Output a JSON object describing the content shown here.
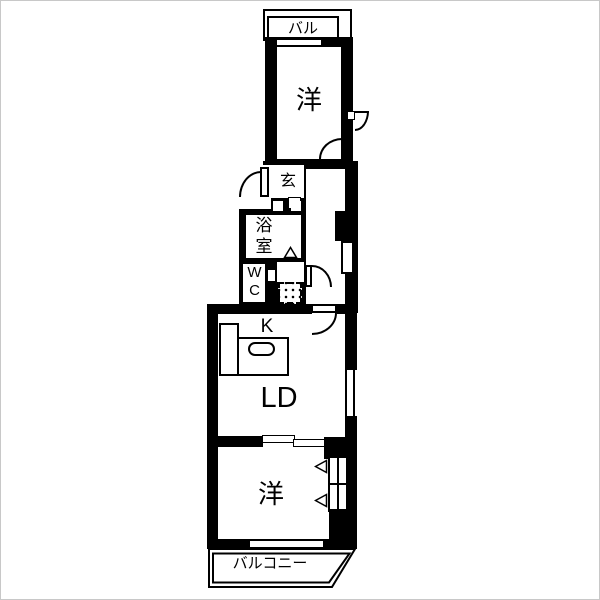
{
  "plan": {
    "title": "apartment-floor-plan",
    "rooms": {
      "balcony_top": "バル",
      "room_top": "洋",
      "entrance": "玄",
      "bath": "浴室",
      "toilet": "WC",
      "kitchen": "K",
      "living_dining": "LD",
      "room_bottom": "洋",
      "balcony_bottom": "バルコニー"
    },
    "colors": {
      "wall": "#000000",
      "floor": "#ffffff",
      "frame": "#c8c8c8"
    }
  }
}
